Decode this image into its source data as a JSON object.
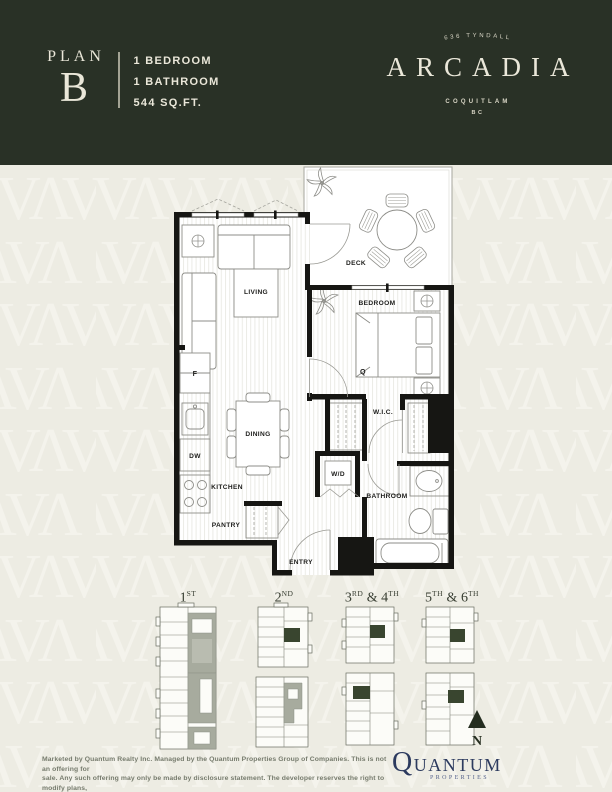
{
  "header": {
    "plan_word": "PLAN",
    "plan_letter": "B",
    "specs": [
      "1 BEDROOM",
      "1 BATHROOM",
      "544 SQ.FT."
    ],
    "logo": {
      "arch": "636 TYNDALL",
      "name": "ARCADIA",
      "city": "COQUITLAM",
      "region": "BC"
    },
    "bg_color": "#293126",
    "text_color": "#eae7d9"
  },
  "floorplan": {
    "labels": {
      "living": "LIVING",
      "deck": "DECK",
      "bedroom": "BEDROOM",
      "bed_size": "Q",
      "wic": "W.I.C.",
      "dining": "DINING",
      "wd": "W/D",
      "bathroom": "BATHROOM",
      "kitchen": "KITCHEN",
      "dw": "DW",
      "fridge": "F",
      "pantry": "PANTRY",
      "entry": "ENTRY"
    }
  },
  "keyplans": {
    "floors": [
      {
        "n1": "1",
        "s1": "ST",
        "join": "",
        "n2": "",
        "s2": ""
      },
      {
        "n1": "2",
        "s1": "ND",
        "join": "",
        "n2": "",
        "s2": ""
      },
      {
        "n1": "3",
        "s1": "RD",
        "join": " & ",
        "n2": "4",
        "s2": "TH"
      },
      {
        "n1": "5",
        "s1": "TH",
        "join": " & ",
        "n2": "6",
        "s2": "TH"
      }
    ],
    "compass_label": "N",
    "highlight_color": "#39452f"
  },
  "footer": {
    "disclaimer_lines": [
      "Marketed by Quantum Realty Inc. Managed by the Quantum Properties Group of Companies. This is not an offering for",
      "sale. Any such offering may only be made by disclosure statement. The developer reserves the right to modify plans,",
      "prices, features and specifications without notice as may be necessary and at their sole discretion. E. & O. E."
    ],
    "brand_name": "QUANTUM",
    "brand_sub": "PROPERTIES",
    "brand_color": "#2c3a5e"
  }
}
